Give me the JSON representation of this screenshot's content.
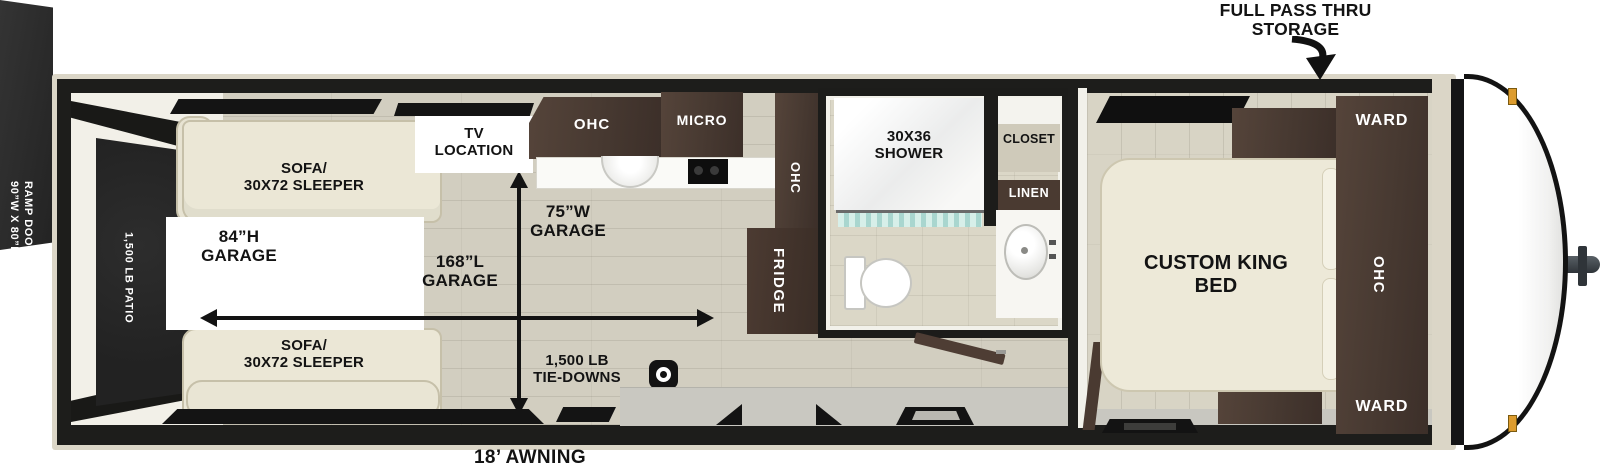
{
  "colors": {
    "wall": "#1d1d1b",
    "shell": "#dbd6c7",
    "floor": "#d2cec0",
    "wood_dark": "#4a3a31",
    "sofa_cream": "#ebe7d6",
    "patio_dark": "#262626",
    "marker_amber": "#dd9c2e",
    "curtain_teal": "#a9d6cf",
    "text": "#131313"
  },
  "exterior": {
    "pass_thru": "FULL PASS THRU\nSTORAGE",
    "awning": "18’ AWNING",
    "ramp_size": "90”W X 80”H\nRAMP DOOR",
    "ramp_capacity": "3,000 LB RAMP\nDOOR"
  },
  "garage": {
    "patio": "1,500 LB PATIO",
    "sofa_top": "SOFA/\n30X72 SLEEPER",
    "sofa_bottom": "SOFA/\n30X72 SLEEPER",
    "height": "84”H\nGARAGE",
    "length": "168”L\nGARAGE",
    "width": "75”W\nGARAGE",
    "tie_downs": "1,500 LB\nTIE-DOWNS",
    "tv": "TV\nLOCATION"
  },
  "kitchen": {
    "ohc_top": "OHC",
    "micro": "MICRO",
    "ohc_side": "OHC",
    "fridge": "FRIDGE"
  },
  "bathroom": {
    "shower": "30X36\nSHOWER",
    "closet": "CLOSET",
    "linen": "LINEN"
  },
  "bedroom": {
    "bed": "CUSTOM KING\nBED",
    "ward_top": "WARD",
    "ohc": "OHC",
    "ward_bottom": "WARD"
  }
}
